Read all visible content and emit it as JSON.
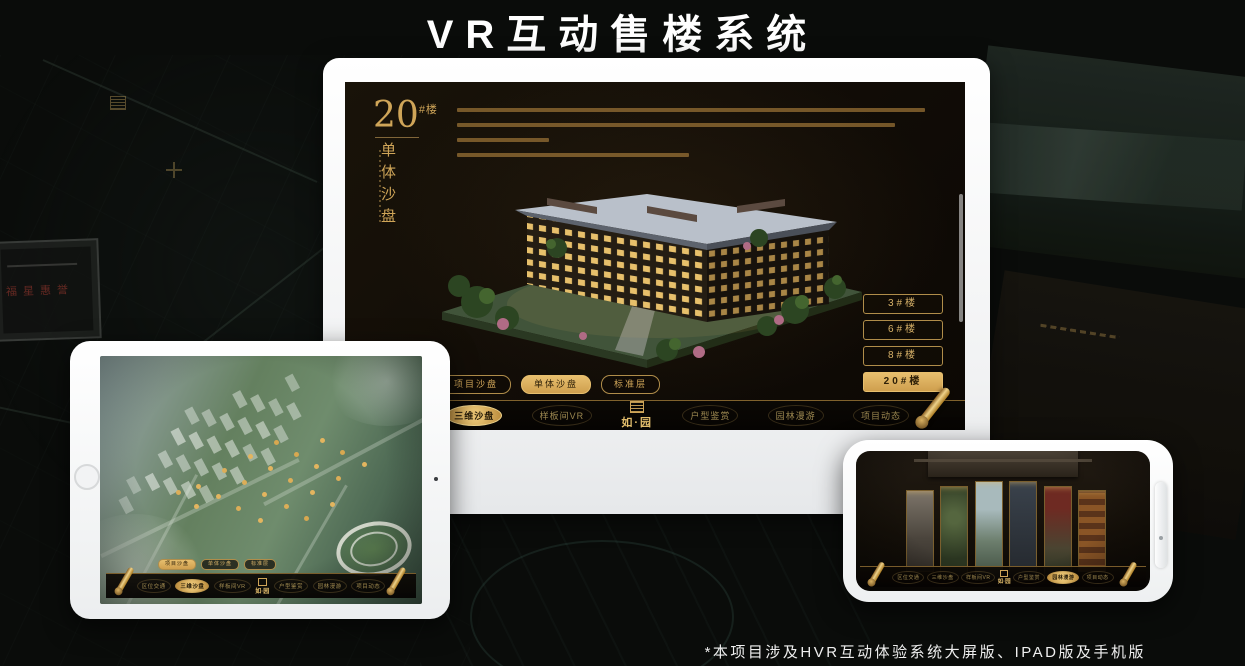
{
  "title": "VR互动售楼系统",
  "caption": "*本项目涉及HVR互动体验系统大屏版、IPAD版及手机版",
  "colors": {
    "accent_gold": "#d8ae5f",
    "screen_dark": "#14100a",
    "background": "#0a0c0a"
  },
  "background": {
    "plaque_text": "福星惠誉"
  },
  "monitor": {
    "section": {
      "number": "20",
      "unit": "#楼",
      "subtitle": "单体沙盘"
    },
    "building_buttons": [
      {
        "label": "3#楼",
        "active": false
      },
      {
        "label": "6#楼",
        "active": false
      },
      {
        "label": "8#楼",
        "active": false
      },
      {
        "label": "20#楼",
        "active": true
      }
    ],
    "tabs": [
      {
        "label": "项目沙盘",
        "active": false
      },
      {
        "label": "单体沙盘",
        "active": true
      },
      {
        "label": "标准层",
        "active": false
      }
    ],
    "nav": {
      "logo": "如·园",
      "items": [
        {
          "label": "区位交通",
          "active": false
        },
        {
          "label": "三维沙盘",
          "active": true
        },
        {
          "label": "样板间VR",
          "active": false
        },
        {
          "label": "户型鉴赏",
          "active": false
        },
        {
          "label": "园林漫游",
          "active": false
        },
        {
          "label": "项目动态",
          "active": false
        }
      ]
    }
  },
  "tablet": {
    "tabs": [
      {
        "label": "项目沙盘",
        "active": true
      },
      {
        "label": "单体沙盘",
        "active": false
      },
      {
        "label": "标准层",
        "active": false
      }
    ],
    "nav": {
      "logo": "如·园",
      "items": [
        {
          "label": "区位交通",
          "active": false
        },
        {
          "label": "三维沙盘",
          "active": true
        },
        {
          "label": "样板间VR",
          "active": false
        },
        {
          "label": "户型鉴赏",
          "active": false
        },
        {
          "label": "园林漫游",
          "active": false
        },
        {
          "label": "项目动态",
          "active": false
        }
      ]
    }
  },
  "phone": {
    "nav": {
      "logo": "如·园",
      "items": [
        {
          "label": "区位交通",
          "active": false
        },
        {
          "label": "三维沙盘",
          "active": false
        },
        {
          "label": "样板间VR",
          "active": false
        },
        {
          "label": "户型鉴赏",
          "active": false
        },
        {
          "label": "园林漫游",
          "active": true
        },
        {
          "label": "项目动态",
          "active": false
        }
      ]
    }
  }
}
